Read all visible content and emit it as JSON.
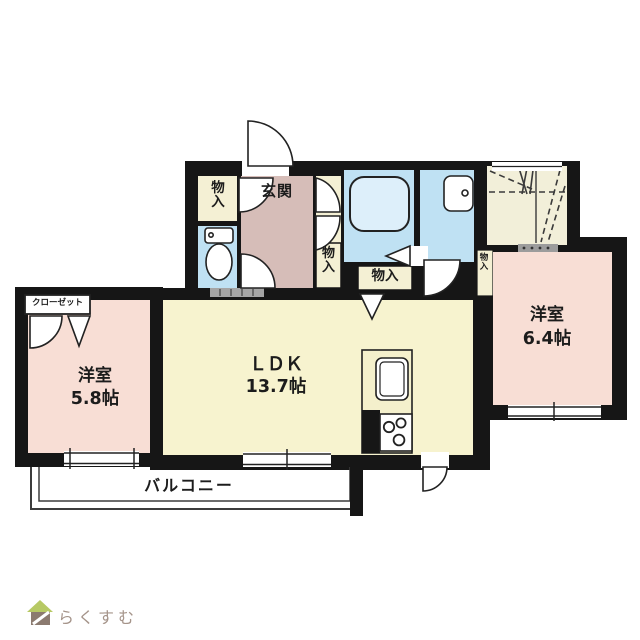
{
  "plan": {
    "labels": {
      "entrance": "玄関",
      "storage": "物入",
      "closet": "クローゼット",
      "balcony": "バルコニー",
      "ldk_name": "ＬＤＫ",
      "ldk_size": "13.7帖",
      "bedroom_left_name": "洋室",
      "bedroom_left_size": "5.8帖",
      "bedroom_right_name": "洋室",
      "bedroom_right_size": "6.4帖"
    },
    "colors": {
      "wall": "#161616",
      "room_pink": "#f8ded5",
      "ldk_cream": "#f7f3cf",
      "entrance_mauve": "#d6bdb8",
      "wet_area_blue": "#bfe1f3",
      "storage_cream": "#f4f0d4",
      "dashed_area_cream": "#f2efd9",
      "sill_gray": "#a5a5a5"
    }
  },
  "logo": {
    "text": "らくすむ",
    "roof_color": "#b7c964",
    "body_color": "#8b7a6f",
    "text_color": "#a5948a"
  }
}
